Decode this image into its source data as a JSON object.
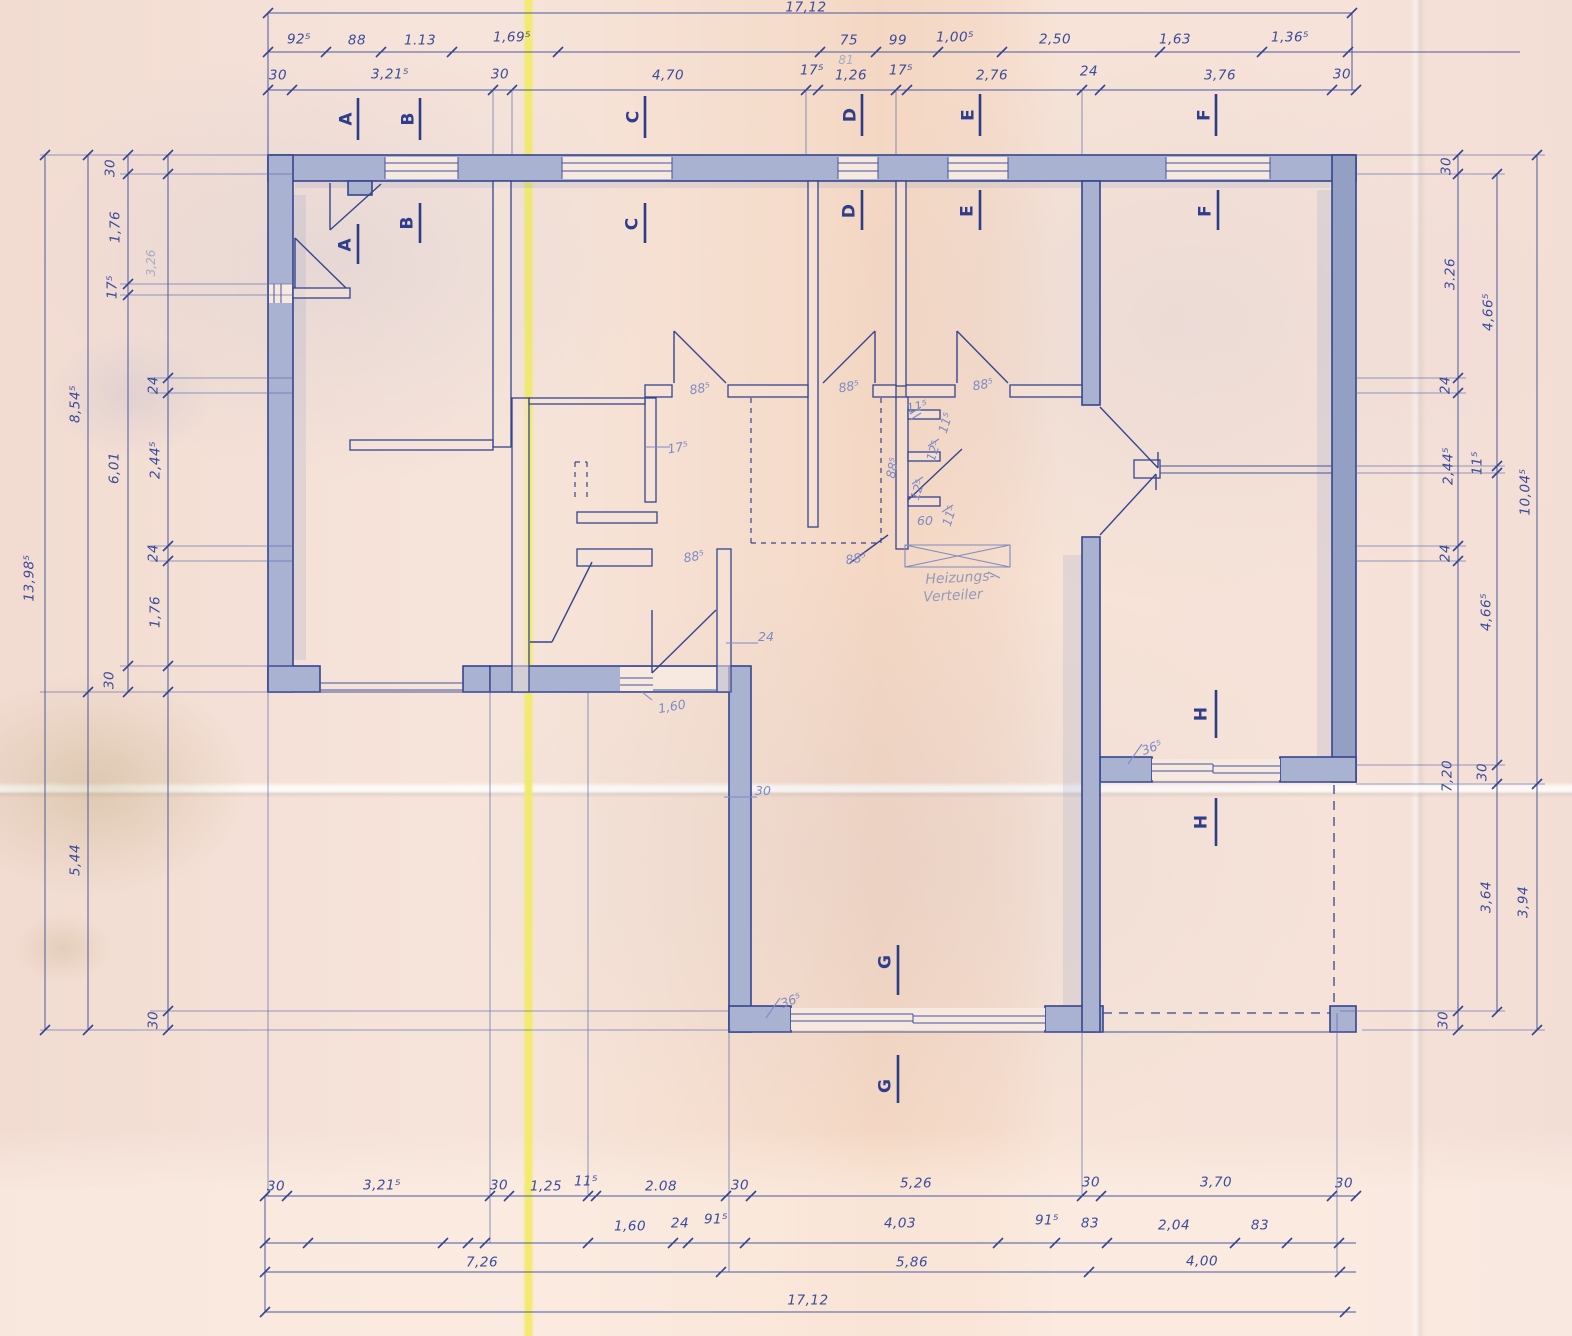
{
  "drawing_type": "floor plan blueprint",
  "annotations": {
    "heating_distributor_line1": "Heizungs-",
    "heating_distributor_line2": "Verteiler"
  },
  "colors": {
    "ink": "#35458e",
    "wall_fill": "#a9b2d0",
    "paper": "#f5dfd5",
    "fold_line": "#f2eb69",
    "handwriting": "#7d8bc4"
  },
  "totals": {
    "width": "17,12",
    "height_left": "13,98⁵"
  },
  "labels": [
    {
      "t": "17,12",
      "x": 806,
      "y": 8,
      "r": 0,
      "c": "dim"
    },
    {
      "t": "92⁵",
      "x": 299,
      "y": 40,
      "r": 0,
      "c": "dim"
    },
    {
      "t": "88",
      "x": 357,
      "y": 41,
      "r": 0,
      "c": "dim"
    },
    {
      "t": "1.13",
      "x": 420,
      "y": 41,
      "r": 0,
      "c": "dim"
    },
    {
      "t": "1,69⁵",
      "x": 512,
      "y": 38,
      "r": 0,
      "c": "dim"
    },
    {
      "t": "75",
      "x": 849,
      "y": 41,
      "r": 0,
      "c": "dim"
    },
    {
      "t": "81",
      "x": 846,
      "y": 60,
      "r": 0,
      "c": "pencil"
    },
    {
      "t": "99",
      "x": 898,
      "y": 41,
      "r": 0,
      "c": "dim"
    },
    {
      "t": "1,00⁵",
      "x": 955,
      "y": 38,
      "r": 0,
      "c": "dim"
    },
    {
      "t": "2,50",
      "x": 1055,
      "y": 40,
      "r": 0,
      "c": "dim"
    },
    {
      "t": "1,63",
      "x": 1175,
      "y": 40,
      "r": 0,
      "c": "dim"
    },
    {
      "t": "1,36⁵",
      "x": 1290,
      "y": 38,
      "r": 0,
      "c": "dim"
    },
    {
      "t": "30",
      "x": 278,
      "y": 76,
      "r": 0,
      "c": "dim"
    },
    {
      "t": "3,21⁵",
      "x": 390,
      "y": 75,
      "r": 0,
      "c": "dim"
    },
    {
      "t": "30",
      "x": 500,
      "y": 75,
      "r": 0,
      "c": "dim"
    },
    {
      "t": "4,70",
      "x": 668,
      "y": 76,
      "r": 0,
      "c": "dim"
    },
    {
      "t": "17⁵",
      "x": 812,
      "y": 71,
      "r": 0,
      "c": "dim"
    },
    {
      "t": "1,26",
      "x": 851,
      "y": 76,
      "r": 0,
      "c": "dim"
    },
    {
      "t": "17⁵",
      "x": 901,
      "y": 71,
      "r": 0,
      "c": "dim"
    },
    {
      "t": "2,76",
      "x": 992,
      "y": 76,
      "r": 0,
      "c": "dim"
    },
    {
      "t": "24",
      "x": 1089,
      "y": 72,
      "r": 0,
      "c": "dim"
    },
    {
      "t": "3,76",
      "x": 1220,
      "y": 76,
      "r": 0,
      "c": "dim"
    },
    {
      "t": "30",
      "x": 1342,
      "y": 75,
      "r": 0,
      "c": "dim"
    },
    {
      "t": "A",
      "x": 347,
      "y": 119,
      "r": -90,
      "c": "letter"
    },
    {
      "t": "B",
      "x": 409,
      "y": 119,
      "r": -90,
      "c": "letter"
    },
    {
      "t": "C",
      "x": 634,
      "y": 117,
      "r": -90,
      "c": "letter"
    },
    {
      "t": "D",
      "x": 851,
      "y": 115,
      "r": -90,
      "c": "letter"
    },
    {
      "t": "E",
      "x": 969,
      "y": 115,
      "r": -90,
      "c": "letter"
    },
    {
      "t": "F",
      "x": 1205,
      "y": 115,
      "r": -90,
      "c": "letter"
    },
    {
      "t": "A",
      "x": 346,
      "y": 245,
      "r": -90,
      "c": "letter"
    },
    {
      "t": "B",
      "x": 408,
      "y": 223,
      "r": -90,
      "c": "letter"
    },
    {
      "t": "C",
      "x": 633,
      "y": 224,
      "r": -90,
      "c": "letter"
    },
    {
      "t": "D",
      "x": 850,
      "y": 211,
      "r": -90,
      "c": "letter"
    },
    {
      "t": "E",
      "x": 968,
      "y": 211,
      "r": -90,
      "c": "letter"
    },
    {
      "t": "F",
      "x": 1206,
      "y": 211,
      "r": -90,
      "c": "letter"
    },
    {
      "t": "H",
      "x": 1202,
      "y": 714,
      "r": -90,
      "c": "letter"
    },
    {
      "t": "H",
      "x": 1202,
      "y": 822,
      "r": -90,
      "c": "letter"
    },
    {
      "t": "G",
      "x": 886,
      "y": 962,
      "r": -90,
      "c": "letter"
    },
    {
      "t": "G",
      "x": 886,
      "y": 1086,
      "r": -90,
      "c": "letter"
    },
    {
      "t": "13,98⁵",
      "x": 30,
      "y": 578,
      "r": -90,
      "c": "dim"
    },
    {
      "t": "8,54⁵",
      "x": 76,
      "y": 404,
      "r": -90,
      "c": "dim"
    },
    {
      "t": "5,44",
      "x": 76,
      "y": 860,
      "r": -90,
      "c": "dim"
    },
    {
      "t": "30",
      "x": 111,
      "y": 168,
      "r": -90,
      "c": "dim"
    },
    {
      "t": "1,76",
      "x": 116,
      "y": 227,
      "r": -90,
      "c": "dim"
    },
    {
      "t": "17⁵",
      "x": 113,
      "y": 287,
      "r": -90,
      "c": "dim"
    },
    {
      "t": "6,01",
      "x": 115,
      "y": 468,
      "r": -90,
      "c": "dim"
    },
    {
      "t": "30",
      "x": 110,
      "y": 680,
      "r": -90,
      "c": "dim"
    },
    {
      "t": "3,26",
      "x": 151,
      "y": 263,
      "r": -90,
      "c": "pencil"
    },
    {
      "t": "24",
      "x": 154,
      "y": 385,
      "r": -90,
      "c": "dim"
    },
    {
      "t": "2,44⁵",
      "x": 156,
      "y": 460,
      "r": -90,
      "c": "dim"
    },
    {
      "t": "24",
      "x": 154,
      "y": 553,
      "r": -90,
      "c": "dim"
    },
    {
      "t": "1,76",
      "x": 156,
      "y": 612,
      "r": -90,
      "c": "dim"
    },
    {
      "t": "30",
      "x": 154,
      "y": 1020,
      "r": -90,
      "c": "dim"
    },
    {
      "t": "30",
      "x": 1447,
      "y": 166,
      "r": -90,
      "c": "dim"
    },
    {
      "t": "3.26",
      "x": 1451,
      "y": 274,
      "r": -90,
      "c": "dim"
    },
    {
      "t": "24",
      "x": 1446,
      "y": 385,
      "r": -90,
      "c": "dim"
    },
    {
      "t": "2,44⁵",
      "x": 1449,
      "y": 466,
      "r": -90,
      "c": "dim"
    },
    {
      "t": "24",
      "x": 1446,
      "y": 553,
      "r": -90,
      "c": "dim"
    },
    {
      "t": "7,20",
      "x": 1448,
      "y": 776,
      "r": -90,
      "c": "dim"
    },
    {
      "t": "30",
      "x": 1444,
      "y": 1020,
      "r": -90,
      "c": "dim"
    },
    {
      "t": "4,66⁵",
      "x": 1489,
      "y": 312,
      "r": -90,
      "c": "dim"
    },
    {
      "t": "11⁵",
      "x": 1478,
      "y": 463,
      "r": -90,
      "c": "dim"
    },
    {
      "t": "4,66⁵",
      "x": 1487,
      "y": 612,
      "r": -90,
      "c": "dim"
    },
    {
      "t": "30",
      "x": 1483,
      "y": 772,
      "r": -90,
      "c": "dim"
    },
    {
      "t": "3,64",
      "x": 1487,
      "y": 897,
      "r": -90,
      "c": "dim"
    },
    {
      "t": "10,04⁵",
      "x": 1526,
      "y": 492,
      "r": -90,
      "c": "dim"
    },
    {
      "t": "3,94",
      "x": 1524,
      "y": 902,
      "r": -90,
      "c": "dim"
    },
    {
      "t": "30",
      "x": 276,
      "y": 1187,
      "r": 0,
      "c": "dim"
    },
    {
      "t": "3,21⁵",
      "x": 382,
      "y": 1186,
      "r": 0,
      "c": "dim"
    },
    {
      "t": "30",
      "x": 499,
      "y": 1186,
      "r": 0,
      "c": "dim"
    },
    {
      "t": "1,25",
      "x": 546,
      "y": 1187,
      "r": 0,
      "c": "dim"
    },
    {
      "t": "11⁵",
      "x": 586,
      "y": 1182,
      "r": 0,
      "c": "dim"
    },
    {
      "t": "2.08",
      "x": 661,
      "y": 1187,
      "r": 0,
      "c": "dim"
    },
    {
      "t": "30",
      "x": 740,
      "y": 1186,
      "r": 0,
      "c": "dim"
    },
    {
      "t": "5,26",
      "x": 916,
      "y": 1184,
      "r": 0,
      "c": "dim"
    },
    {
      "t": "30",
      "x": 1091,
      "y": 1183,
      "r": 0,
      "c": "dim"
    },
    {
      "t": "3,70",
      "x": 1216,
      "y": 1183,
      "r": 0,
      "c": "dim"
    },
    {
      "t": "30",
      "x": 1344,
      "y": 1184,
      "r": 0,
      "c": "dim"
    },
    {
      "t": "1,60",
      "x": 630,
      "y": 1227,
      "r": 0,
      "c": "dim"
    },
    {
      "t": "24",
      "x": 680,
      "y": 1224,
      "r": 0,
      "c": "dim"
    },
    {
      "t": "91⁵",
      "x": 716,
      "y": 1220,
      "r": 0,
      "c": "dim"
    },
    {
      "t": "4,03",
      "x": 900,
      "y": 1224,
      "r": 0,
      "c": "dim"
    },
    {
      "t": "91⁵",
      "x": 1047,
      "y": 1221,
      "r": 0,
      "c": "dim"
    },
    {
      "t": "83",
      "x": 1090,
      "y": 1224,
      "r": 0,
      "c": "dim"
    },
    {
      "t": "2,04",
      "x": 1174,
      "y": 1226,
      "r": 0,
      "c": "dim"
    },
    {
      "t": "83",
      "x": 1260,
      "y": 1226,
      "r": 0,
      "c": "dim"
    },
    {
      "t": "7,26",
      "x": 482,
      "y": 1263,
      "r": 0,
      "c": "dim"
    },
    {
      "t": "5,86",
      "x": 912,
      "y": 1263,
      "r": 0,
      "c": "dim"
    },
    {
      "t": "4,00",
      "x": 1202,
      "y": 1262,
      "r": 0,
      "c": "dim"
    },
    {
      "t": "17,12",
      "x": 808,
      "y": 1301,
      "r": 0,
      "c": "dim"
    },
    {
      "t": "88⁵",
      "x": 700,
      "y": 389,
      "r": -10,
      "c": "hand"
    },
    {
      "t": "88⁵",
      "x": 849,
      "y": 387,
      "r": -10,
      "c": "hand"
    },
    {
      "t": "88⁵",
      "x": 983,
      "y": 385,
      "r": -10,
      "c": "hand"
    },
    {
      "t": "88⁵",
      "x": 694,
      "y": 557,
      "r": -10,
      "c": "hand"
    },
    {
      "t": "88⁵",
      "x": 856,
      "y": 559,
      "r": -10,
      "c": "hand"
    },
    {
      "t": "88⁵",
      "x": 893,
      "y": 468,
      "r": -78,
      "c": "hand"
    },
    {
      "t": "17⁵",
      "x": 678,
      "y": 448,
      "r": -10,
      "c": "hand"
    },
    {
      "t": "24",
      "x": 766,
      "y": 637,
      "r": 0,
      "c": "hand"
    },
    {
      "t": "1,60",
      "x": 672,
      "y": 707,
      "r": -10,
      "c": "hand"
    },
    {
      "t": "30",
      "x": 763,
      "y": 791,
      "r": 0,
      "c": "hand"
    },
    {
      "t": "36⁵",
      "x": 1152,
      "y": 748,
      "r": -20,
      "c": "hand"
    },
    {
      "t": "36⁵",
      "x": 791,
      "y": 1001,
      "r": -20,
      "c": "hand"
    },
    {
      "t": "11⁵",
      "x": 917,
      "y": 407,
      "r": -12,
      "c": "hand"
    },
    {
      "t": "11⁵",
      "x": 946,
      "y": 423,
      "r": -72,
      "c": "hand"
    },
    {
      "t": "12⁵",
      "x": 934,
      "y": 451,
      "r": -72,
      "c": "hand"
    },
    {
      "t": "12⁵",
      "x": 918,
      "y": 490,
      "r": -72,
      "c": "hand"
    },
    {
      "t": "60",
      "x": 925,
      "y": 521,
      "r": 0,
      "c": "hand"
    },
    {
      "t": "11⁵",
      "x": 950,
      "y": 516,
      "r": -72,
      "c": "hand"
    },
    {
      "t": "Heizungs-",
      "x": 960,
      "y": 578,
      "r": -3,
      "c": "hand2"
    },
    {
      "t": "Verteiler",
      "x": 953,
      "y": 596,
      "r": -3,
      "c": "hand2"
    }
  ]
}
